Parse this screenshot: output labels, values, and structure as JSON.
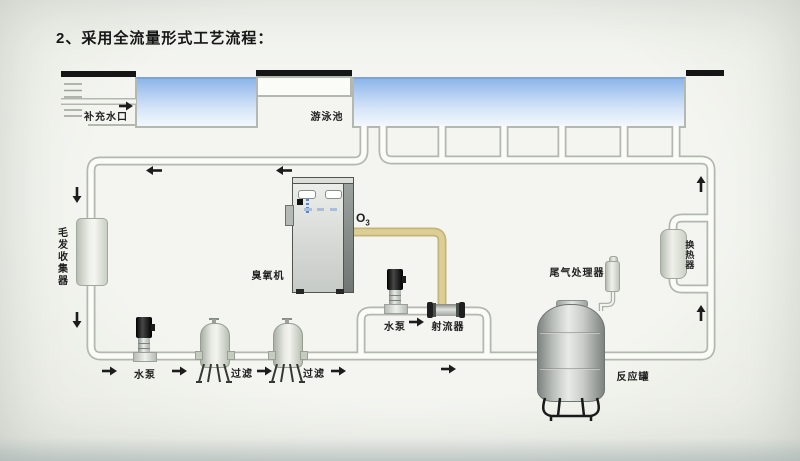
{
  "title": "2、采用全流量形式工艺流程：",
  "pool": {
    "makeup_water_inlet": "补充水口",
    "swimming_pool": "游泳池"
  },
  "labels": {
    "hair_collector": "毛发收集器",
    "ozone_machine": "臭氧机",
    "ozone_symbol": "O",
    "ozone_subscript": "3",
    "injector_pump": "水泵",
    "jet_injector": "射流器",
    "main_pump": "水泵",
    "filter_1": "过滤",
    "filter_2": "过滤",
    "tail_gas_processor": "尾气处理器",
    "reaction_tank": "反应罐",
    "heat_exchanger": "换热器"
  },
  "icons": {
    "flow_arrow": "black solid directional arrow",
    "hatch": "wall hatch marks at makeup water inlet"
  },
  "colors": {
    "background": "#f2f3ee",
    "pool_water_top": "#8db5e9",
    "pool_water_bottom": "#f3f8fd",
    "pipe_outline": "#b3b8af",
    "pipe_fill": "#fbfbf7",
    "ozone_pipe_outline": "#c3b478",
    "ozone_pipe_fill": "#dccf95",
    "deck_bar": "#151515",
    "arrow": "#1c1c1c"
  }
}
